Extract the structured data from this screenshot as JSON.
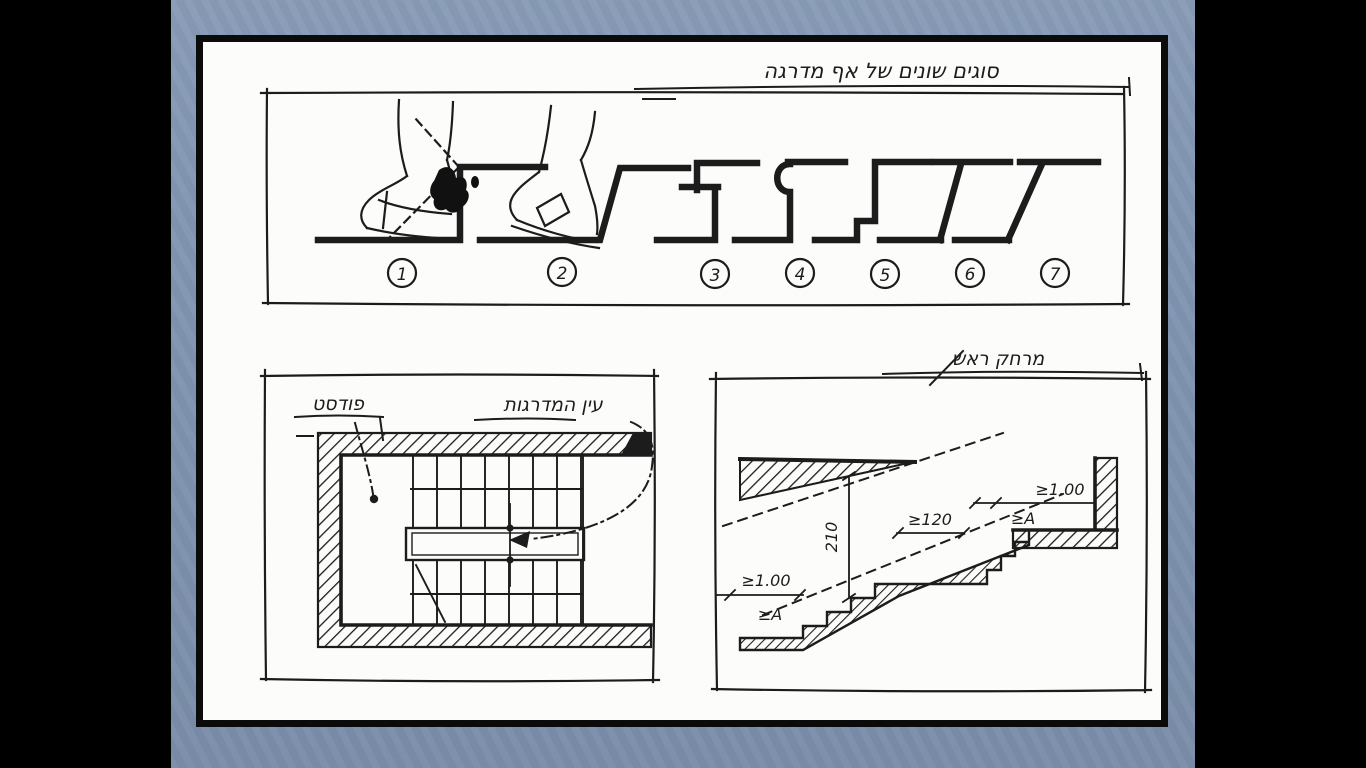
{
  "slide": {
    "letterbox_color": "#000000",
    "background_color": "#8195b2",
    "page_color": "#fcfcfa",
    "ink_color": "#1c1c1c"
  },
  "top_panel": {
    "caption": "סוגים שונים של אף מדרגה",
    "items": [
      {
        "num": "1",
        "type": "vertical-riser-toe-collision"
      },
      {
        "num": "2",
        "type": "inclined-riser"
      },
      {
        "num": "3",
        "type": "nosing-drip-lip"
      },
      {
        "num": "4",
        "type": "rounded-bullnose"
      },
      {
        "num": "5",
        "type": "recessed-lower-riser"
      },
      {
        "num": "6",
        "type": "slanted-riser-overhang"
      },
      {
        "num": "7",
        "type": "deep-slanted-riser-overhang"
      }
    ]
  },
  "plan_panel": {
    "landing_label": "פודסט",
    "eye_label": "עין המדרגות"
  },
  "section_panel": {
    "caption": "מרחק ראש",
    "headroom_dim": "210",
    "landing_dim": "≥120",
    "bottom_width_dim": "≥1.00",
    "bottom_width_letter": "≥A",
    "top_width_dim": "≥1.00",
    "top_width_letter": "≥A"
  }
}
